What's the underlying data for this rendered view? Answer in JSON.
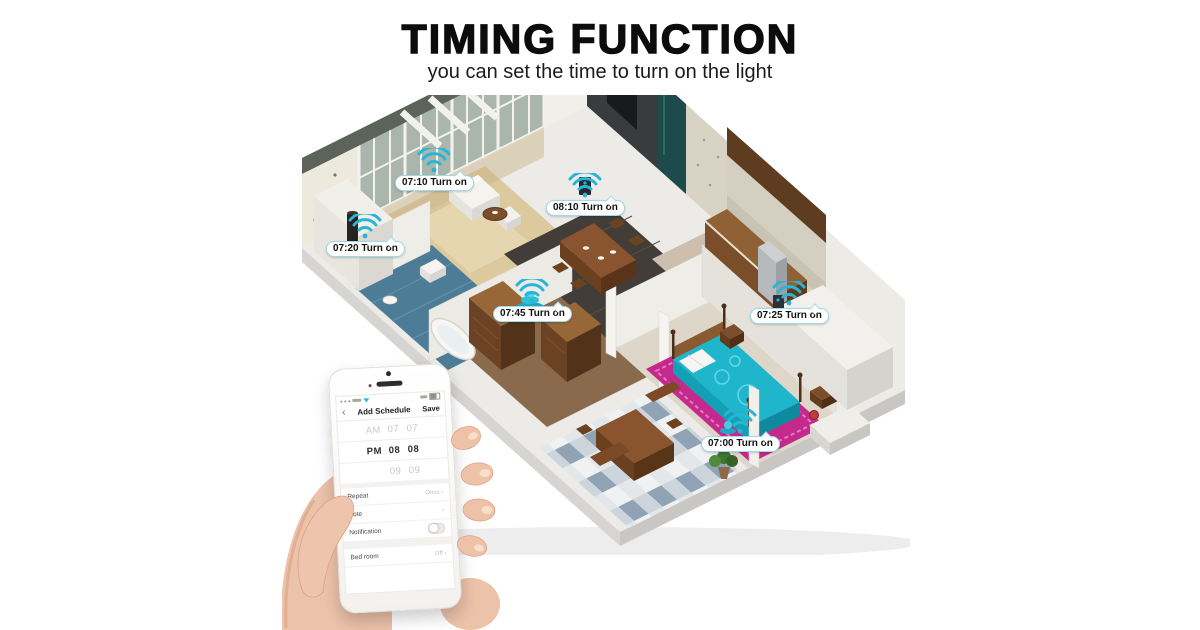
{
  "header": {
    "title": "TIMING FUNCTION",
    "subtitle": "you can set the time to turn on the light"
  },
  "floorplan": {
    "accent_color": "#27b5d8",
    "markers": [
      {
        "id": "living-window",
        "label": "07:10 Turn on"
      },
      {
        "id": "media-wall",
        "label": "08:10 Turn on"
      },
      {
        "id": "floor-lamp",
        "label": "07:20 Turn on"
      },
      {
        "id": "hall-fountain",
        "label": "07:45 Turn on"
      },
      {
        "id": "kitchen",
        "label": "07:25 Turn on"
      },
      {
        "id": "bedroom-lamp",
        "label": "07:00 Turn on"
      }
    ]
  },
  "phone": {
    "nav": {
      "back": "‹",
      "title": "Add Schedule",
      "save": "Save"
    },
    "picker": {
      "rows": [
        {
          "period": "AM",
          "hour": "07",
          "minute": "07"
        },
        {
          "period": "PM",
          "hour": "08",
          "minute": "08"
        },
        {
          "period": "",
          "hour": "09",
          "minute": "09"
        }
      ]
    },
    "settings": {
      "repeat_label": "Repeat",
      "repeat_value": "Once ›",
      "note_label": "Note",
      "note_value": "›",
      "notification_label": "Notification",
      "room_label": "Bed room",
      "room_value": "Off ›"
    }
  }
}
